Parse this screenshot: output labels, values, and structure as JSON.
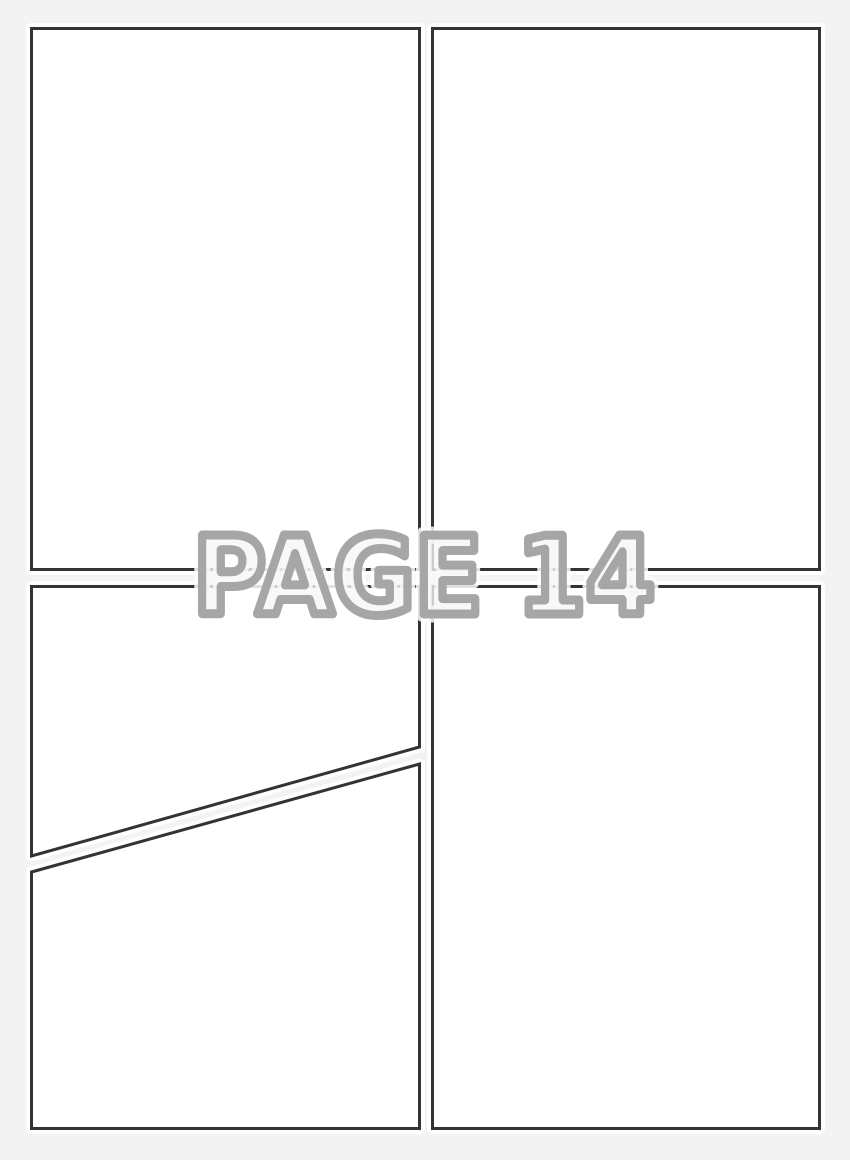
{
  "watermark": {
    "text": "PAGE 14"
  },
  "panels": {
    "count": 5
  },
  "colors": {
    "background": "#f3f3f3",
    "panel_fill": "#ffffff",
    "panel_border": "#333333",
    "panel_halo": "#ffffff",
    "watermark_fill": "#f6f6f6",
    "watermark_outline": "#a6a6a6",
    "watermark_halo": "#ffffff"
  }
}
